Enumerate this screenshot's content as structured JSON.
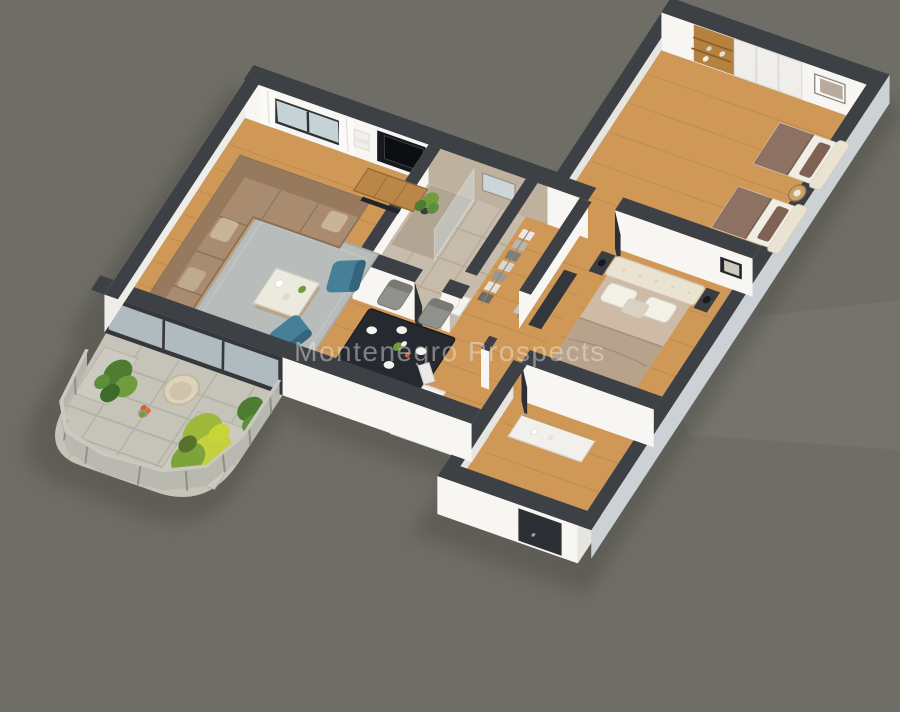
{
  "scene": {
    "watermark": "Montenegro Prospects",
    "description": "isometric-3d-apartment-floor-plan-render",
    "palette": {
      "background": "#6f6e66",
      "shadow": "#383732",
      "wall_top": "#3d4145",
      "wall_face": "#f7f6f3",
      "wall_face_shaded": "#e7e5df",
      "wall_exterior_lit": "#ccd1d6",
      "floor_wood": "#d09857",
      "plank_line": "#a8763d",
      "floor_marble": "#c7bcab",
      "marble_line": "#b0a492",
      "shower_tile": "#b2a593",
      "balcony_floor": "#c6c3b9",
      "railing": "#b9b8b0",
      "rug": "#b8bdbb",
      "sofa": "#a98c6f",
      "sofa_back": "#97795e",
      "armchair_teal": "#457f98",
      "coffee_table": "#eceade",
      "tv_console_wood": "#bb8748",
      "tv_panel": "#17191d",
      "glass": "#c5d2d6",
      "dining_table": "#26292f",
      "dining_chair": "#90908c",
      "kitchen_counter": "#efeeec",
      "appliance_dark": "#24272b",
      "fruit_orange": "#f59e2d",
      "fruit_yellow": "#ffd23e",
      "bed_headboard": "#eae3d2",
      "master_bedding": "#cdbba7",
      "master_blanket": "#b7a28c",
      "kids_mattress": "#f0ede5",
      "kids_blanket": "#8d7162",
      "kids_pillow": "#7e6254",
      "nightstand_dark": "#3a3e43",
      "wood_furniture": "#b5813f",
      "plant_dark_green": "#4e7d32",
      "plant_green": "#6f9c3d",
      "plant_yellow_green": "#c3d23c",
      "flower_orange": "#d95f2b",
      "door_dark": "#2c2f33",
      "frame_dark": "#23262a",
      "watermark_color": "rgba(235,235,230,0.45)"
    },
    "rooms": [
      {
        "name": "living-room",
        "furniture": [
          "corner-sofa",
          "gray-rug",
          "coffee-table",
          "two-teal-armchairs",
          "tv-console",
          "tv-panel",
          "wall-shelves",
          "window-with-curtains",
          "floor-plant"
        ]
      },
      {
        "name": "dining-area",
        "furniture": [
          "black-dining-table",
          "four-gray-chairs",
          "plates",
          "flower-vase"
        ]
      },
      {
        "name": "kitchen",
        "furniture": [
          "counter-with-sink",
          "cooktop",
          "open-fridge-with-fruit",
          "tall-dark-appliance"
        ]
      },
      {
        "name": "bathroom",
        "furniture": [
          "walk-in-shower",
          "glass-screen",
          "toilet",
          "vanity-with-basin",
          "mirror"
        ]
      },
      {
        "name": "wardrobe-corridor",
        "furniture": [
          "hanging-clothes-rails"
        ]
      },
      {
        "name": "master-bedroom",
        "furniture": [
          "double-bed-tufted-headboard",
          "two-nightstands-with-lamps",
          "dark-wardrobe",
          "bench-with-towels",
          "wall-art"
        ]
      },
      {
        "name": "kids-bedroom",
        "furniture": [
          "two-single-beds",
          "round-side-table-with-lamp",
          "built-in-wardrobes",
          "wall-art-frames"
        ]
      },
      {
        "name": "entrance-hall",
        "furniture": [
          "white-shoe-cabinet",
          "entry-door"
        ]
      },
      {
        "name": "balcony",
        "furniture": [
          "curved-chevron-railing",
          "planter-boxes",
          "yellow-green-bush",
          "leafy-plant",
          "wicker-chair",
          "orange-flowers"
        ]
      }
    ]
  }
}
